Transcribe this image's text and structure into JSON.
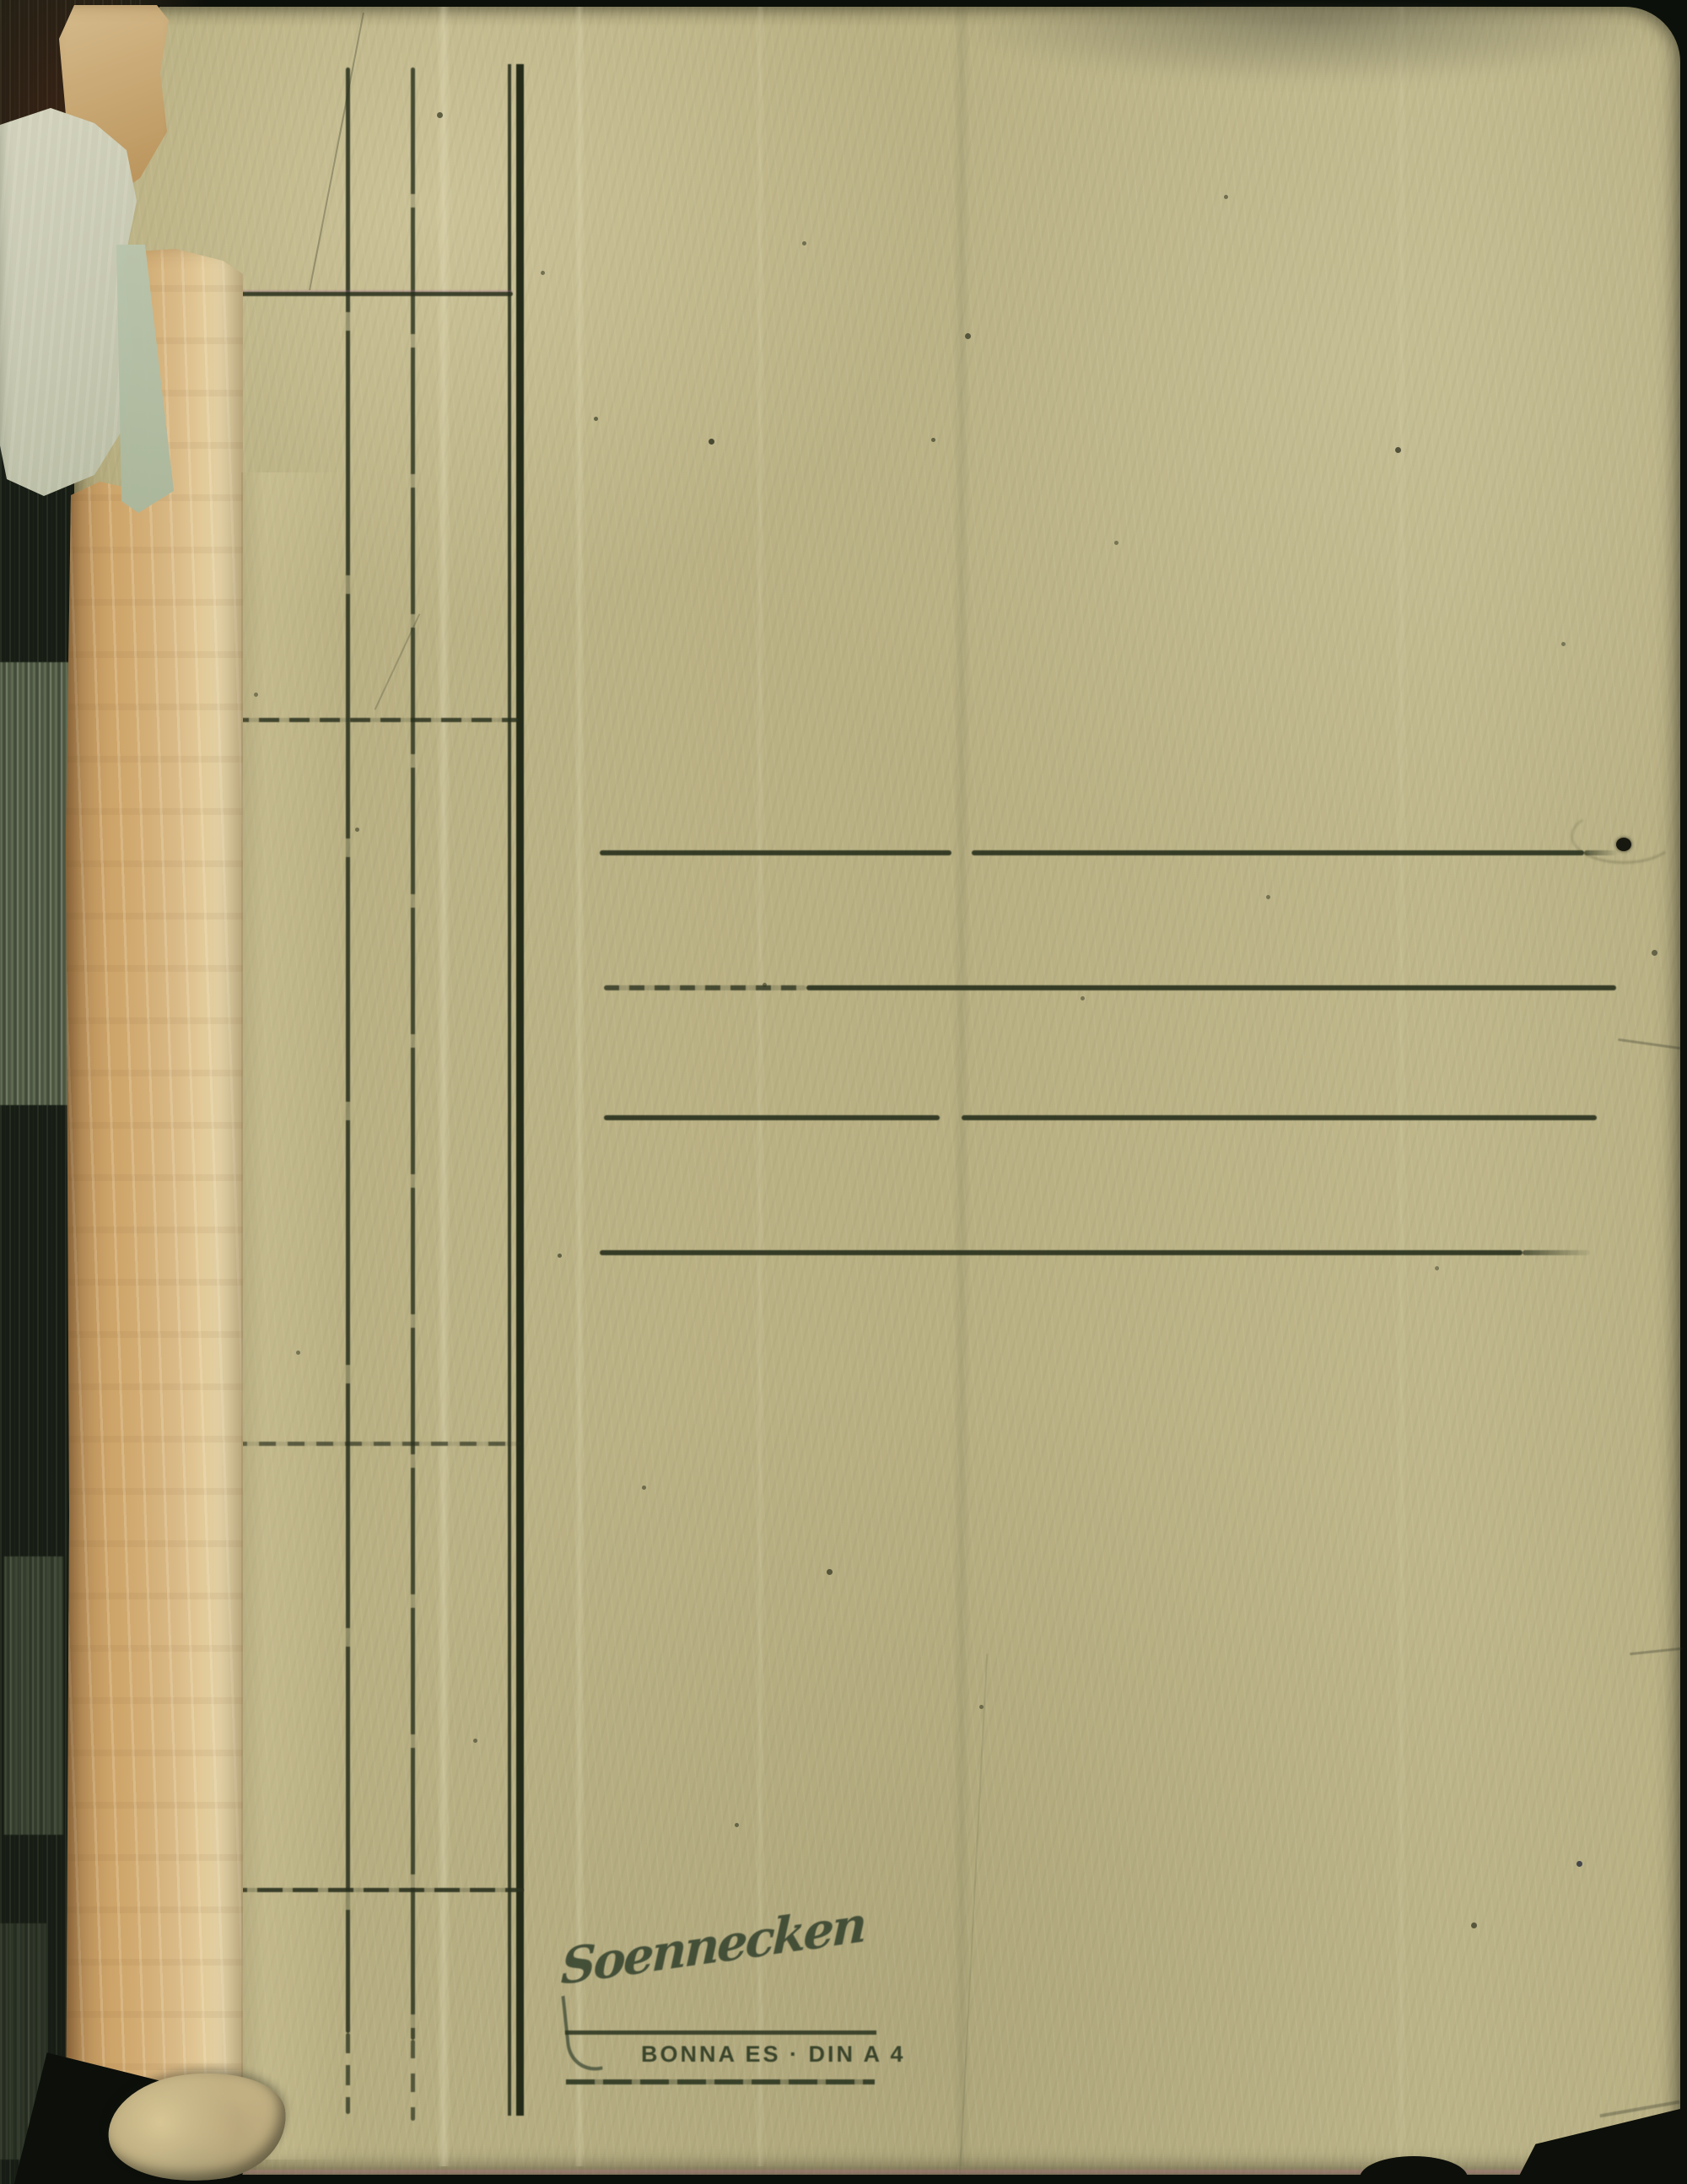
{
  "scan": {
    "subject": "Back cover of an aged Soennecken cardboard file folder, scanned against a dark background with the page block edge visible on the left",
    "brand": {
      "script_logo": "Soennecken",
      "product_line": "BONNA ES · DIN A 4"
    },
    "ruling": {
      "left_vertical_columns": 3,
      "left_horizontal_rules": 4,
      "title_rule_lines": 4
    },
    "colors": {
      "folder_body": "#bbb286",
      "spine_tape": "#cfa671",
      "printed_ink": "#2a331f",
      "torn_paper_pale": "#cdceb6",
      "scanner_background": "#0c100a"
    }
  }
}
